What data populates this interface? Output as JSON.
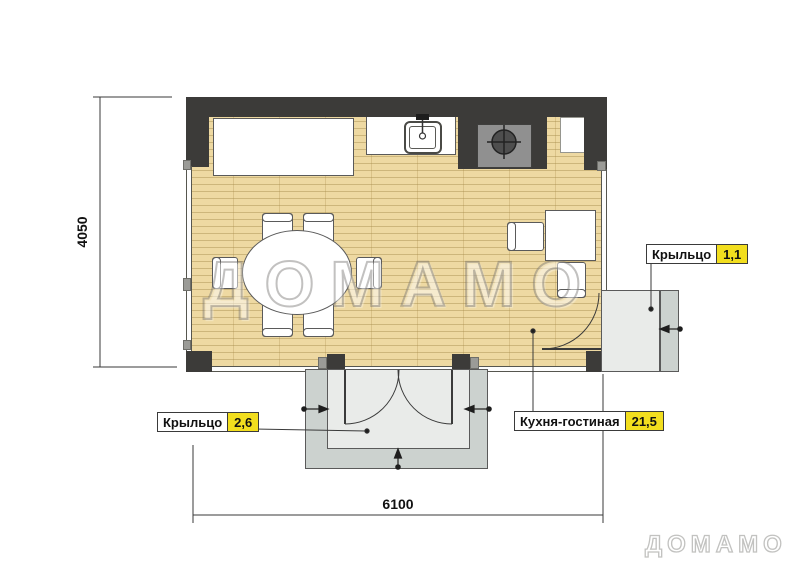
{
  "page": {
    "watermark": "ДОМАМО",
    "brand": "ДОМАМО"
  },
  "dimensions": {
    "width": "6100",
    "height": "4050"
  },
  "rooms": {
    "kitchen_living": {
      "label": "Кухня-гостиная",
      "area": "21,5"
    },
    "porch_bottom": {
      "label": "Крыльцо",
      "area": "2,6"
    },
    "porch_right": {
      "label": "Крыльцо",
      "area": "1,1"
    }
  },
  "colors": {
    "wall": "#3c3b39",
    "floor": "#eed9a2",
    "floor_line": "#cdb67b",
    "porch_step": "#ccd2cf",
    "porch_platform": "#e9ebe9",
    "area_badge_yellow": "#f2de1e",
    "stove_gray": "#909090",
    "watermark_gray": "#9a9a9a"
  }
}
